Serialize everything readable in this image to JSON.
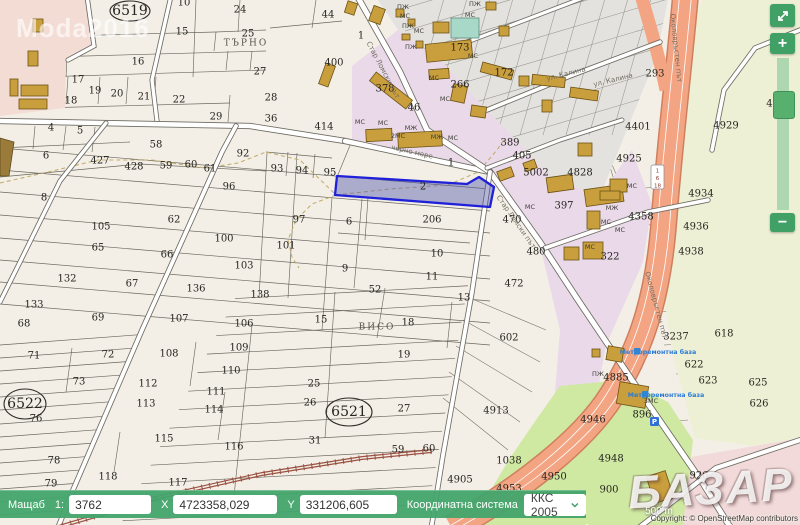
{
  "ui": {
    "watermark_top": "Moda2016",
    "watermark_bottom": "БАЗАР",
    "controls": {
      "zoom_in": "+",
      "zoom_out": "−",
      "fullscreen_icon": "expand-arrows"
    },
    "statusbar": {
      "scale_label": "Мащаб",
      "scale_ratio": "1:",
      "scale_value": "3762",
      "x_label": "X",
      "x_value": "4723358,029",
      "y_label": "Y",
      "y_value": "331206,605",
      "crs_label": "Координатна система",
      "crs_value": "ККС 2005"
    },
    "scalebar": "500 m",
    "attribution": "Copyright: © OpenStreetMap contributors"
  },
  "colors": {
    "ui_green": "#42a46c",
    "selection_blue": "#2020d8",
    "highway_orange": "#f3a583",
    "urban_pink": "#f3dcd4",
    "urban_lavender": "#e9d9e9",
    "field_green": "#cfe8a2",
    "building_gold": "#c99e3c"
  },
  "map": {
    "selected_parcel_label": "2",
    "shield": [
      "1",
      "6",
      "18"
    ],
    "parking_label": "P",
    "labels": [
      [
        "10",
        184,
        3
      ],
      [
        "24",
        240,
        10
      ],
      [
        "15",
        182,
        32
      ],
      [
        "25",
        248,
        34
      ],
      [
        "16",
        138,
        62
      ],
      [
        "27",
        260,
        72
      ],
      [
        "17",
        78,
        80
      ],
      [
        "19",
        95,
        91
      ],
      [
        "20",
        117,
        94
      ],
      [
        "21",
        144,
        97
      ],
      [
        "22",
        179,
        100
      ],
      [
        "18",
        71,
        101
      ],
      [
        "29",
        216,
        117
      ],
      [
        "4",
        51,
        128
      ],
      [
        "5",
        80,
        131
      ],
      [
        "44",
        328,
        15
      ],
      [
        "1",
        361,
        36
      ],
      [
        "400",
        334,
        63
      ],
      [
        "28",
        271,
        98
      ],
      [
        "36",
        271,
        119
      ],
      [
        "414",
        324,
        127
      ],
      [
        "58",
        156,
        145
      ],
      [
        "6",
        46,
        156
      ],
      [
        "427",
        100,
        161
      ],
      [
        "428",
        134,
        167
      ],
      [
        "59",
        166,
        166
      ],
      [
        "60",
        191,
        165
      ],
      [
        "61",
        210,
        169
      ],
      [
        "92",
        243,
        154
      ],
      [
        "93",
        277,
        169
      ],
      [
        "94",
        302,
        171
      ],
      [
        "95",
        330,
        173
      ],
      [
        "96",
        229,
        187
      ],
      [
        "8",
        44,
        198
      ],
      [
        "62",
        174,
        220
      ],
      [
        "105",
        101,
        227
      ],
      [
        "100",
        224,
        239
      ],
      [
        "65",
        98,
        248
      ],
      [
        "66",
        167,
        255
      ],
      [
        "103",
        244,
        266
      ],
      [
        "132",
        67,
        279
      ],
      [
        "67",
        132,
        284
      ],
      [
        "136",
        196,
        289
      ],
      [
        "133",
        34,
        305
      ],
      [
        "69",
        98,
        318
      ],
      [
        "107",
        179,
        319
      ],
      [
        "106",
        244,
        324
      ],
      [
        "68",
        24,
        324
      ],
      [
        "97",
        299,
        220
      ],
      [
        "6",
        349,
        222
      ],
      [
        "206",
        432,
        220
      ],
      [
        "101",
        286,
        246
      ],
      [
        "9",
        345,
        269
      ],
      [
        "10",
        437,
        254
      ],
      [
        "11",
        432,
        277
      ],
      [
        "52",
        375,
        290
      ],
      [
        "13",
        464,
        298
      ],
      [
        "138",
        260,
        295
      ],
      [
        "15",
        321,
        320
      ],
      [
        "472",
        514,
        284
      ],
      [
        "1",
        451,
        163
      ],
      [
        "2",
        423,
        187
      ],
      [
        "71",
        34,
        356
      ],
      [
        "72",
        108,
        355
      ],
      [
        "108",
        169,
        354
      ],
      [
        "109",
        239,
        348
      ],
      [
        "110",
        231,
        371
      ],
      [
        "73",
        79,
        382
      ],
      [
        "112",
        148,
        384
      ],
      [
        "111",
        216,
        392
      ],
      [
        "113",
        146,
        404
      ],
      [
        "114",
        214,
        410
      ],
      [
        "76",
        36,
        419
      ],
      [
        "115",
        164,
        439
      ],
      [
        "116",
        234,
        447
      ],
      [
        "78",
        54,
        461
      ],
      [
        "118",
        108,
        477
      ],
      [
        "117",
        178,
        483
      ],
      [
        "79",
        51,
        484
      ],
      [
        "18",
        408,
        323
      ],
      [
        "19",
        404,
        355
      ],
      [
        "25",
        314,
        384
      ],
      [
        "26",
        310,
        403
      ],
      [
        "27",
        404,
        409
      ],
      [
        "31",
        315,
        441
      ],
      [
        "59",
        398,
        450
      ],
      [
        "60",
        429,
        449
      ],
      [
        "602",
        509,
        338
      ],
      [
        "4913",
        496,
        411
      ],
      [
        "293",
        655,
        74
      ],
      [
        "389",
        510,
        143
      ],
      [
        "405",
        522,
        156
      ],
      [
        "378",
        385,
        89
      ],
      [
        "46",
        414,
        108
      ],
      [
        "266",
        460,
        85
      ],
      [
        "173",
        460,
        48
      ],
      [
        "172",
        504,
        73
      ],
      [
        "4928",
        779,
        104
      ],
      [
        "4929",
        726,
        126
      ],
      [
        "4925",
        629,
        159
      ],
      [
        "4828",
        580,
        173
      ],
      [
        "5002",
        536,
        173
      ],
      [
        "4401",
        638,
        127
      ],
      [
        "397",
        564,
        206
      ],
      [
        "470",
        512,
        220
      ],
      [
        "480",
        536,
        252
      ],
      [
        "4358",
        641,
        217
      ],
      [
        "322",
        610,
        257
      ],
      [
        "4934",
        701,
        194
      ],
      [
        "4936",
        696,
        227
      ],
      [
        "4938",
        691,
        252
      ],
      [
        "3237",
        676,
        337
      ],
      [
        "618",
        724,
        334
      ],
      [
        "622",
        694,
        365
      ],
      [
        "623",
        708,
        381
      ],
      [
        "625",
        758,
        383
      ],
      [
        "626",
        759,
        404
      ],
      [
        "4885",
        616,
        378
      ],
      [
        "896",
        642,
        415
      ],
      [
        "4946",
        593,
        420
      ],
      [
        "4948",
        611,
        459
      ],
      [
        "4950",
        554,
        477
      ],
      [
        "900",
        609,
        490
      ],
      [
        "4953",
        509,
        489
      ],
      [
        "1038",
        509,
        461
      ],
      [
        "4905",
        460,
        480
      ],
      [
        "926",
        699,
        476
      ],
      [
        "6519",
        130,
        11,
        "big"
      ],
      [
        "6522",
        25,
        404,
        "big"
      ],
      [
        "6521",
        349,
        412,
        "big"
      ],
      [
        "ПЖ",
        403,
        7,
        "b"
      ],
      [
        "МС",
        405,
        16,
        "b"
      ],
      [
        "ПЖ",
        408,
        26,
        "b"
      ],
      [
        "МС",
        419,
        31,
        "b"
      ],
      [
        "ПЖ",
        411,
        47,
        "b"
      ],
      [
        "ПЖ",
        475,
        4,
        "b"
      ],
      [
        "МС",
        470,
        15,
        "b"
      ],
      [
        "МС",
        473,
        56,
        "b"
      ],
      [
        "МС",
        434,
        78,
        "b"
      ],
      [
        "МС",
        445,
        99,
        "b"
      ],
      [
        "МС",
        383,
        123,
        "b"
      ],
      [
        "МС",
        360,
        122,
        "b"
      ],
      [
        "МЖ",
        411,
        128,
        "b"
      ],
      [
        "2МС",
        398,
        136,
        "b"
      ],
      [
        "МЖ",
        437,
        137,
        "b"
      ],
      [
        "МС",
        453,
        138,
        "b"
      ],
      [
        "МС",
        530,
        207,
        "b"
      ],
      [
        "МЖ",
        612,
        208,
        "b"
      ],
      [
        "МС",
        606,
        222,
        "b"
      ],
      [
        "МС",
        590,
        247,
        "b"
      ],
      [
        "МС",
        632,
        186,
        "b"
      ],
      [
        "МС",
        620,
        230,
        "b"
      ],
      [
        "3МС",
        651,
        401,
        "b"
      ],
      [
        "ПЖ",
        598,
        374,
        "b"
      ],
      [
        "ТЪРНО",
        246,
        43,
        "loc"
      ],
      [
        "ВИСО",
        377,
        327,
        "loc"
      ],
      [
        "Стар Ломски път",
        383,
        70,
        "st",
        62
      ],
      [
        "Стар Ломски път",
        516,
        222,
        "st",
        55
      ],
      [
        "черно море",
        412,
        152,
        "st",
        13
      ],
      [
        "Околовръстен път",
        676,
        48,
        "st",
        84
      ],
      [
        "Околовръстен път",
        656,
        305,
        "st",
        75
      ],
      [
        "ул. Калина",
        566,
        74,
        "st",
        -14
      ],
      [
        "ул. Калина",
        613,
        80,
        "st",
        -14
      ],
      [
        "Метроремонтна база",
        658,
        352,
        "poi"
      ],
      [
        "Метроремонтна база",
        666,
        395,
        "poi"
      ]
    ]
  }
}
